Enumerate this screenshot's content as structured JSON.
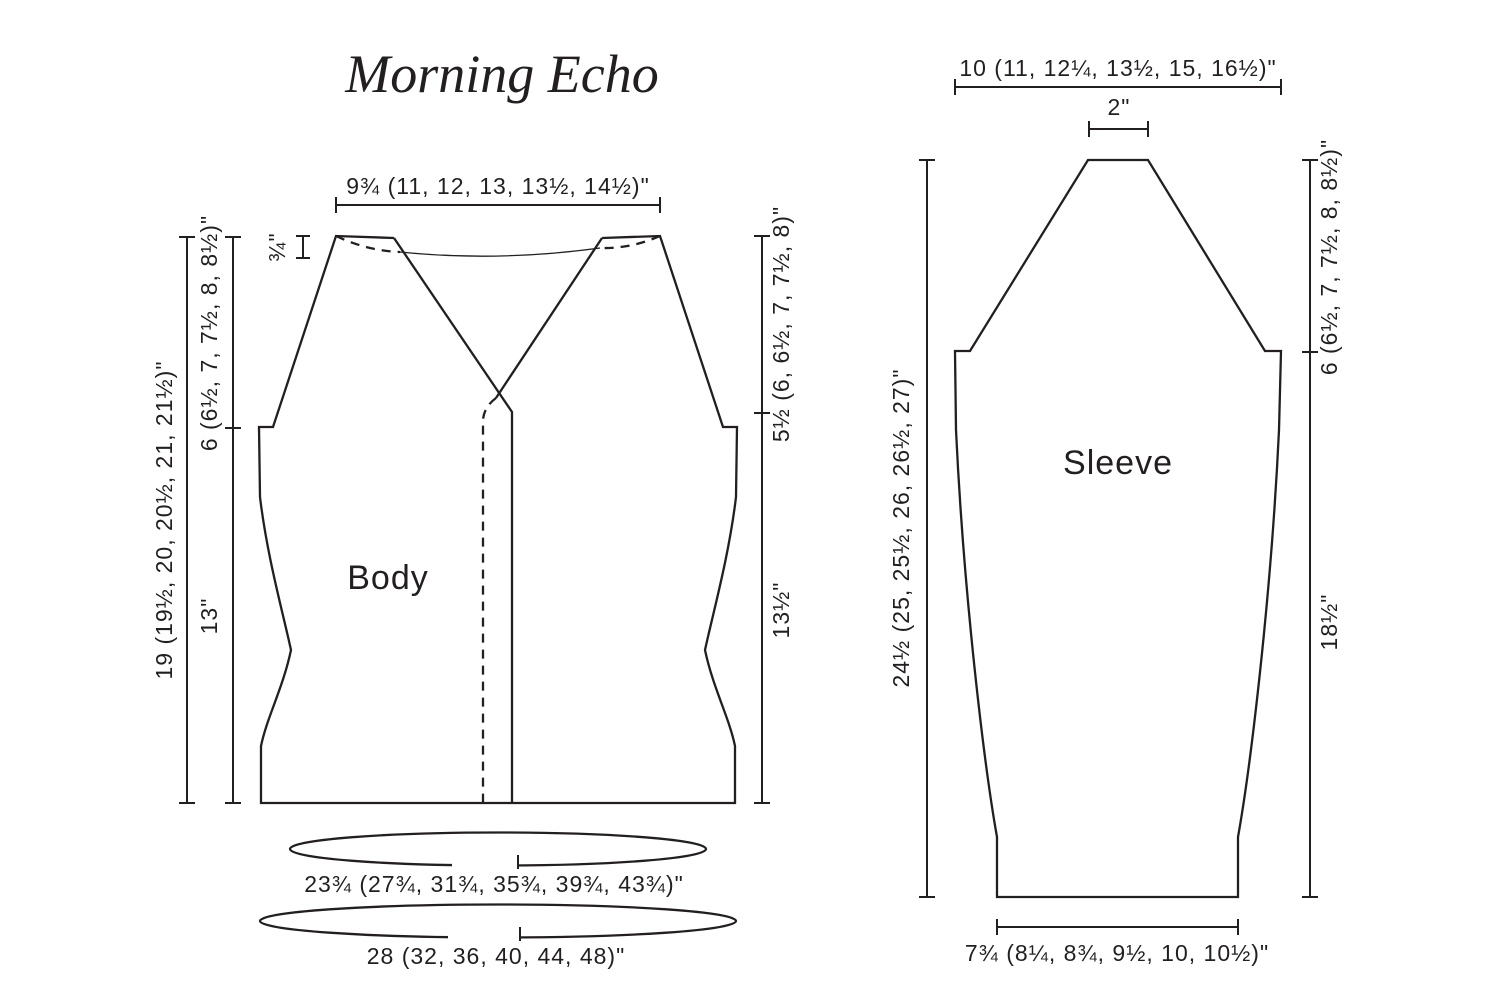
{
  "title": "Morning Echo",
  "body": {
    "label": "Body",
    "top_width": "9¾ (11, 12, 13, 13½, 14½)\"",
    "shoulder_drop": "¾\"",
    "length_total": "19 (19½, 20, 20½, 21, 21½)\"",
    "armhole_depth_left": "6 (6½, 7, 7½, 8, 8½)\"",
    "body_length_left": "13\"",
    "armhole_depth_right": "5½ (6, 6½, 7, 7½, 8)\"",
    "body_length_right": "13½\"",
    "bust_circumference": "23¾ (27¾, 31¾, 35¾, 39¾, 43¾)\"",
    "hem_circumference": "28 (32, 36, 40, 44, 48)\""
  },
  "sleeve": {
    "label": "Sleeve",
    "top_width": "10 (11, 12¼, 13½, 15, 16½)\"",
    "saddle_width": "2\"",
    "length_total": "24½ (25, 25½, 26, 26½, 27)\"",
    "cap_height": "6 (6½, 7, 7½, 8, 8½)\"",
    "lower_sleeve_length": "18½\"",
    "cuff_width": "7¾ (8¼, 8¾, 9½, 10, 10½)\""
  }
}
